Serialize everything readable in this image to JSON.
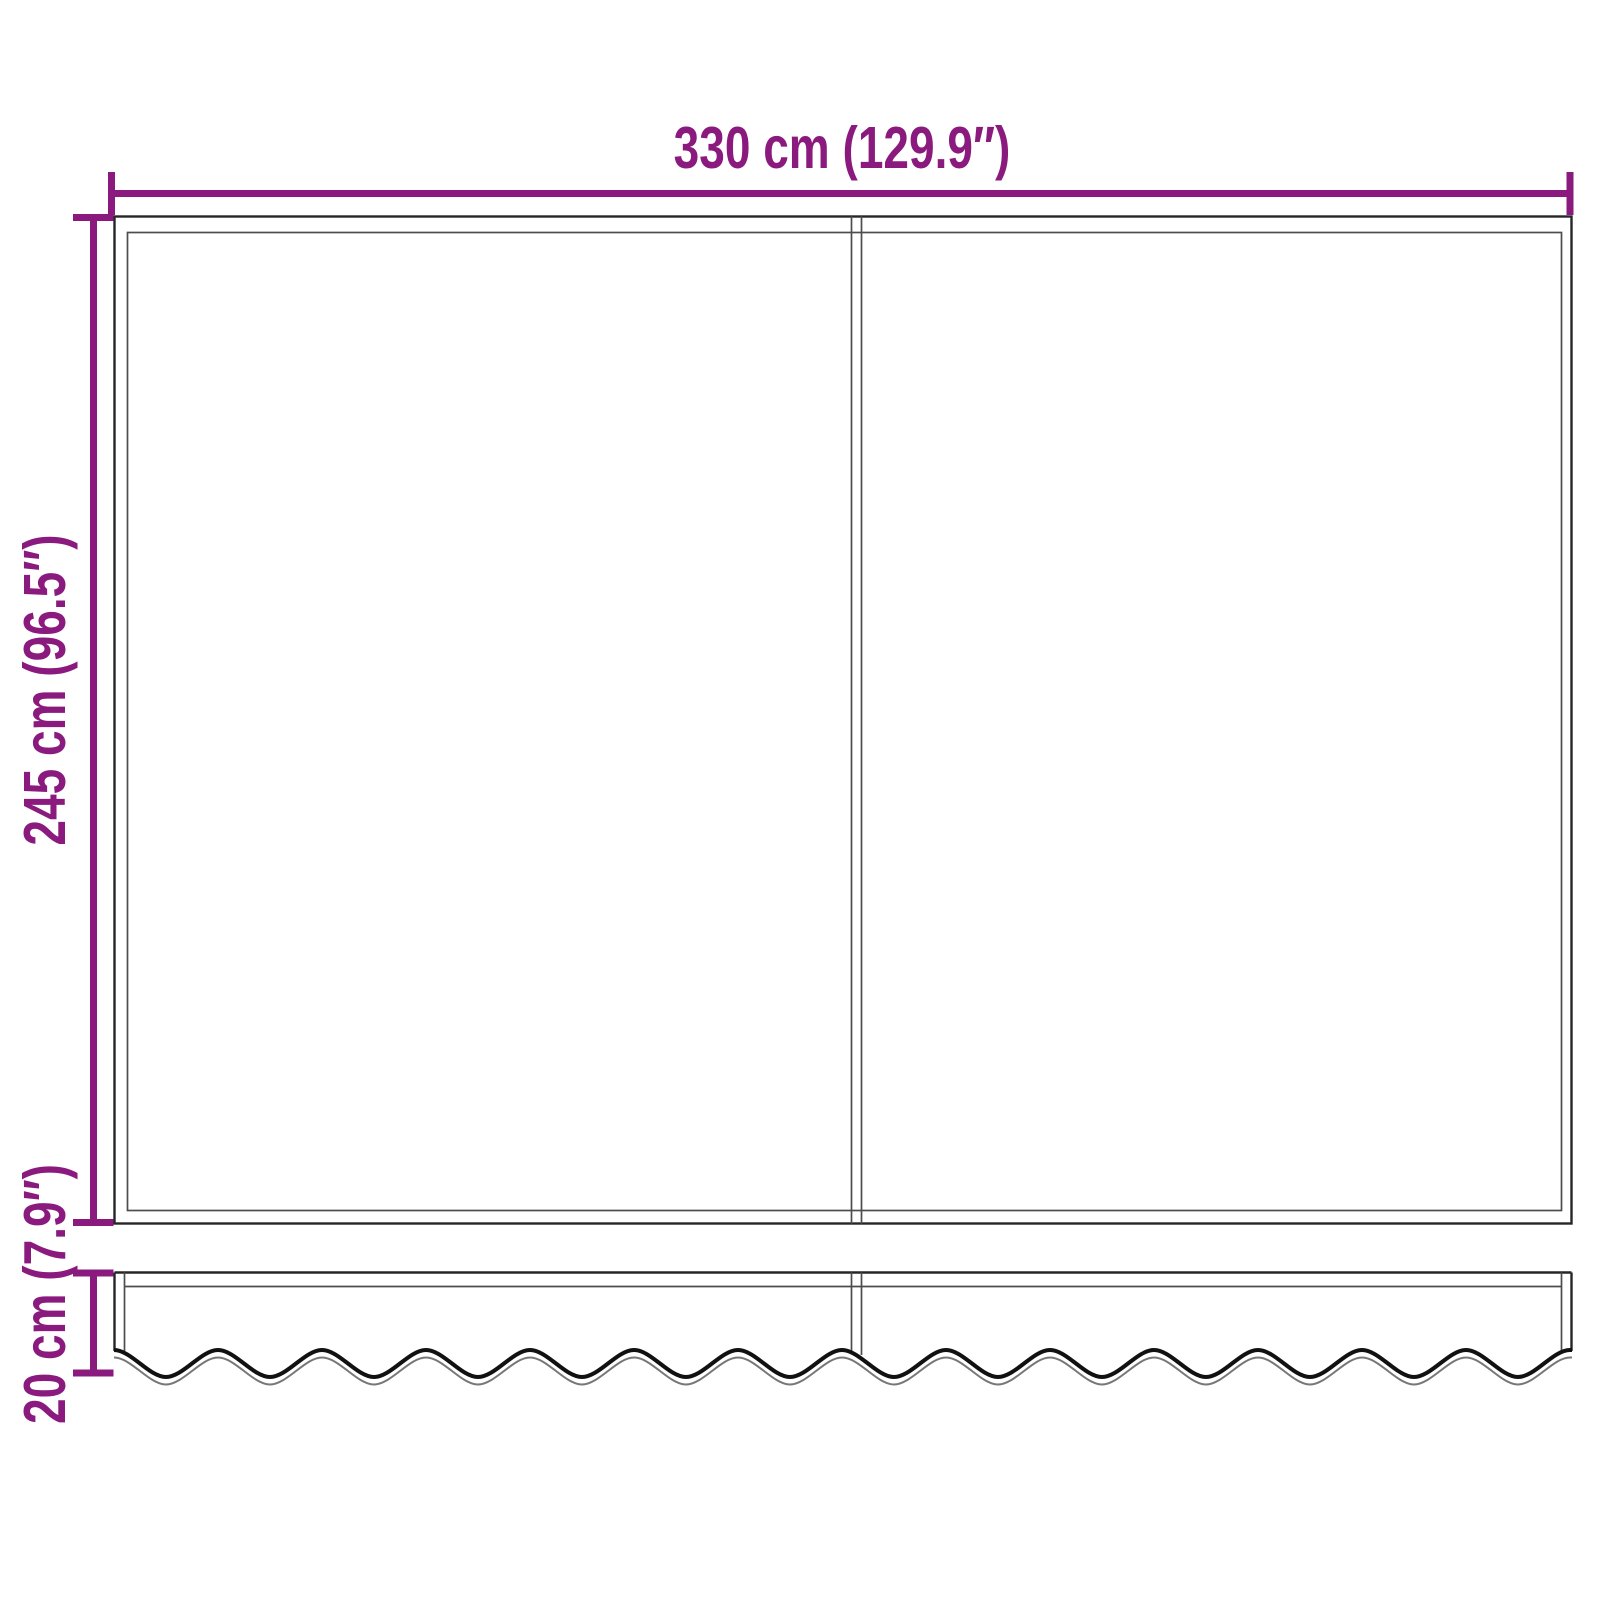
{
  "colors": {
    "accent": "#8b1a7e",
    "frame": "#262626",
    "frame-light": "#4d4d4d",
    "scallop": "#111111",
    "scallop-shadow": "#777777",
    "background": "#ffffff"
  },
  "diagram": {
    "type": "product-dimension-diagram",
    "subject": "awning fabric with scalloped valance, two panels",
    "dimensions": {
      "width": "330 cm (129.9″)",
      "height": "245 cm (96.5″)",
      "valance_height": "20 cm (7.9″)"
    }
  }
}
